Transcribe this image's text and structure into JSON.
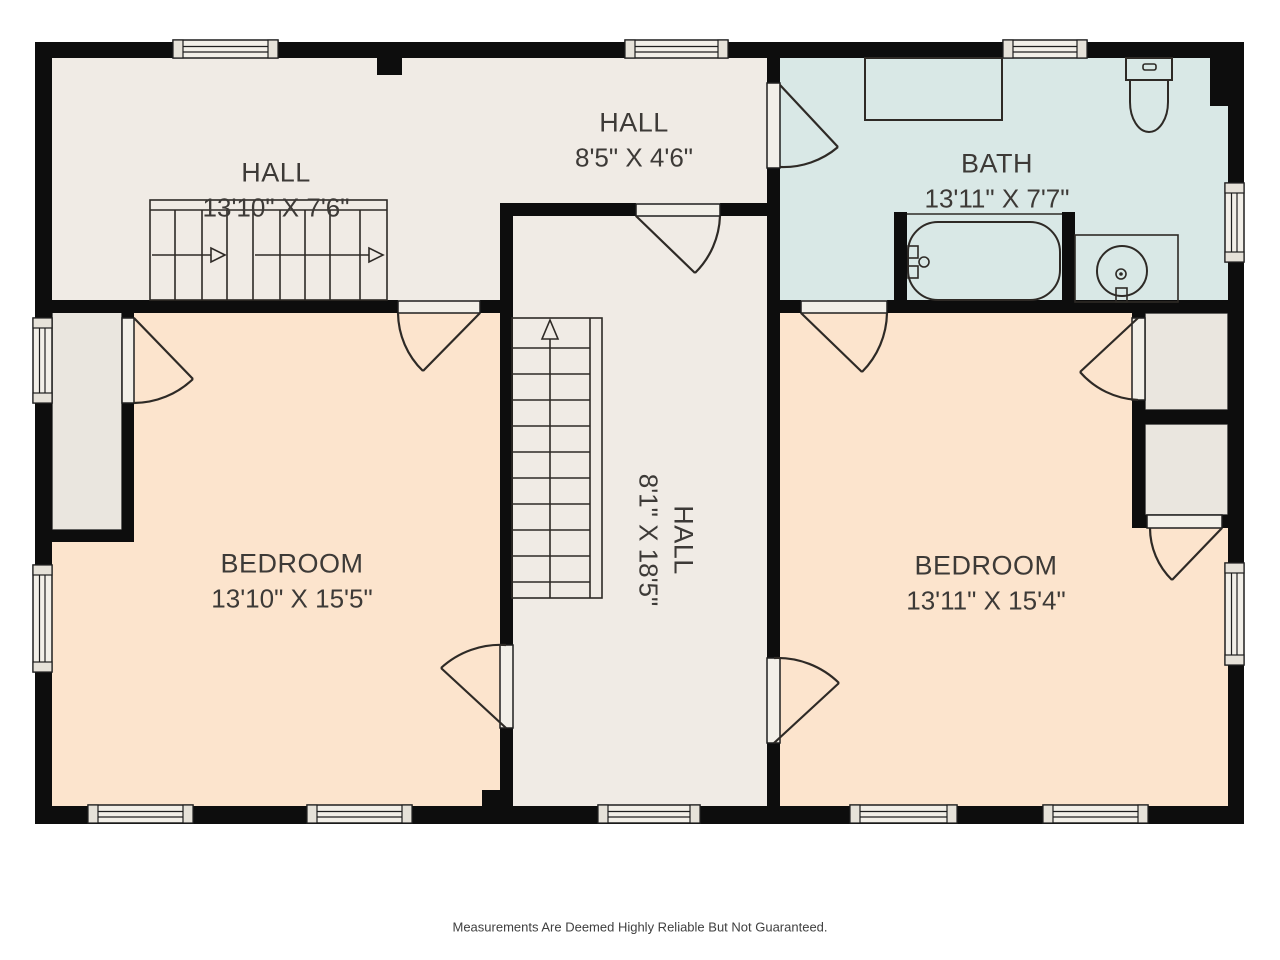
{
  "colors": {
    "page_bg": "#ffffff",
    "wall": "#0d0d0d",
    "hall_floor": "#f0ebe5",
    "bath_floor": "#d9e8e6",
    "bedroom_floor": "#fce4cd",
    "closet_floor": "#eae6df",
    "window_fill": "#f2efe8",
    "label_text": "#3d3a37"
  },
  "rooms": {
    "hall_top_left": {
      "name": "HALL",
      "dims": "13'10\" X 7'6\""
    },
    "hall_top_mid": {
      "name": "HALL",
      "dims": "8'5\" X 4'6\""
    },
    "bath": {
      "name": "BATH",
      "dims": "13'11\" X 7'7\""
    },
    "bedroom_left": {
      "name": "BEDROOM",
      "dims": "13'10\" X 15'5\""
    },
    "hall_center": {
      "name": "HALL",
      "dims": "8'1\" X 18'5\""
    },
    "bedroom_right": {
      "name": "BEDROOM",
      "dims": "13'11\" X 15'4\""
    }
  },
  "footer": {
    "disclaimer": "Measurements Are Deemed Highly Reliable But Not Guaranteed."
  }
}
